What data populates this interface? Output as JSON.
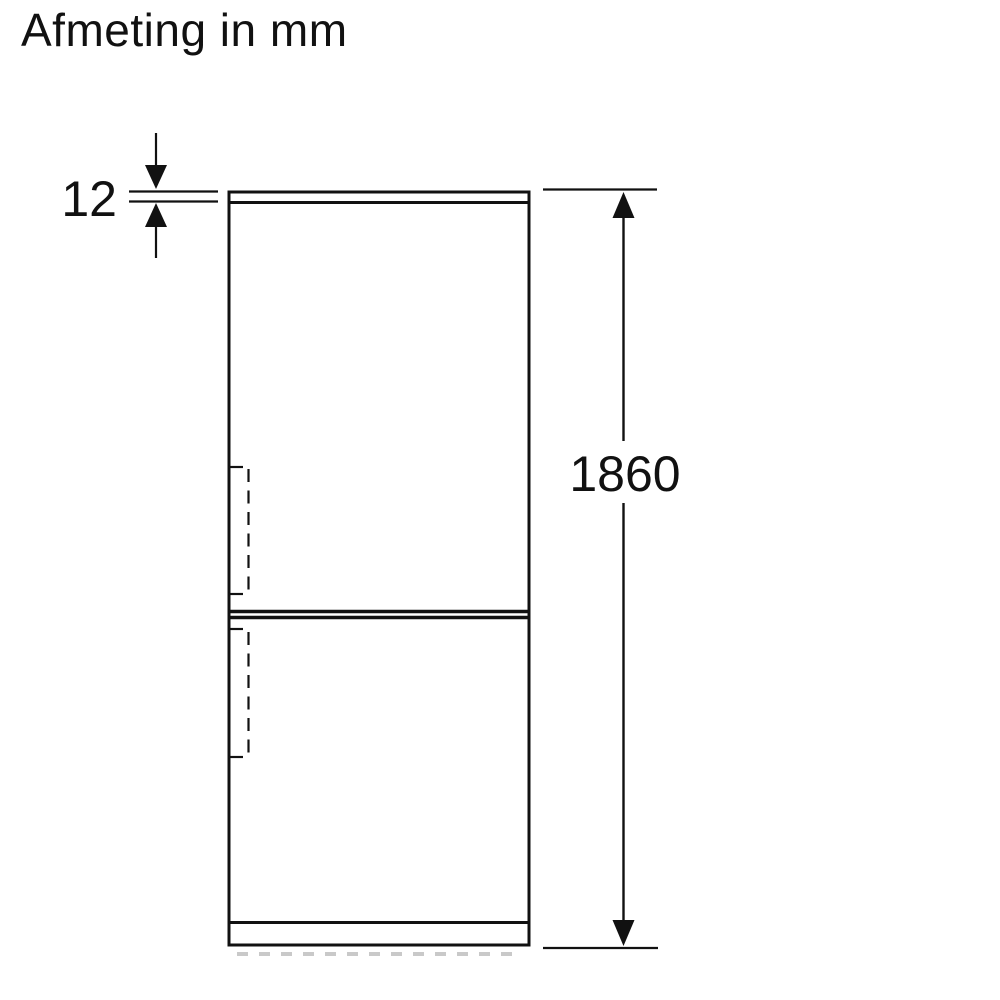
{
  "title": "Afmeting in mm",
  "dimensions": {
    "top_thickness": "12",
    "total_height": "1860"
  },
  "colors": {
    "line": "#111111",
    "background": "#ffffff",
    "floor_dash": "#c9c9c9"
  }
}
